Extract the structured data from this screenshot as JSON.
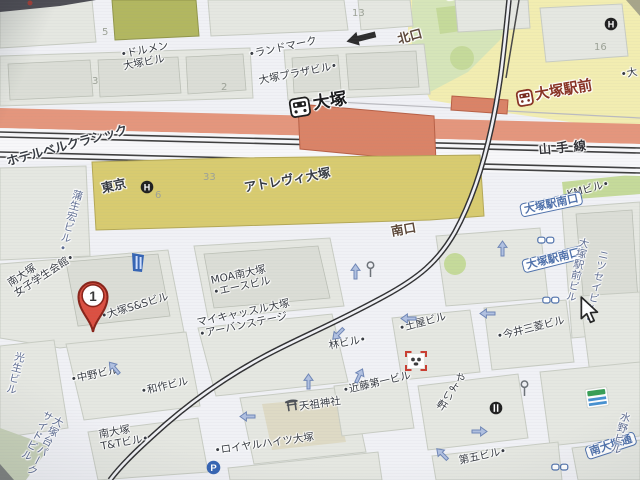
{
  "colors": {
    "road": "#eef0f4",
    "block": "#e3e6df",
    "blockStroke": "#c6cac1",
    "building": "#d9dcd4",
    "buildingStroke": "#b9bdb3",
    "yellow": "#f1ecab",
    "green": "#d4e4b4",
    "green2": "#c2d994",
    "olive": "#b0b657",
    "sage": "#c5cfb5",
    "mustard": "#d8ca67",
    "mustardStroke": "#b3a64e",
    "salmon": "#e79377",
    "salmonDark": "#de7f61",
    "rail": "#3c3c3c",
    "labelBlack": "#33383f",
    "labelBlue": "#5a6a92",
    "stationRed": "#8c2f1f",
    "busBlue": "#4a6fae",
    "exitBrown": "#5a4434",
    "num": "#9aa094",
    "arrowBlue": "#8aa2d0"
  },
  "station": {
    "jr_name": "大塚",
    "tram_stop": "大塚駅前",
    "line": "山手線",
    "north_exit": "北口",
    "south_exit": "南口"
  },
  "pin": {
    "number": "1",
    "points_to": "大塚S&Sビル"
  },
  "labels": [
    {
      "name": "label-mezon-partial",
      "text": "メゾン",
      "x": 376,
      "y": -10,
      "rot": -35,
      "cls": "bldg"
    },
    {
      "name": "label-biru-partial",
      "text": "ビル",
      "x": 444,
      "y": -8,
      "rot": -5,
      "cls": "bldg"
    },
    {
      "name": "block-num-13",
      "text": "13",
      "x": 352,
      "y": 8,
      "cls": "num"
    },
    {
      "name": "block-num-5",
      "text": "5",
      "x": 102,
      "y": 27,
      "cls": "num"
    },
    {
      "name": "block-num-3",
      "text": "3",
      "x": 92,
      "y": 76,
      "cls": "num"
    },
    {
      "name": "block-num-2",
      "text": "2",
      "x": 221,
      "y": 82,
      "cls": "num"
    },
    {
      "name": "block-num-16",
      "text": "16",
      "x": 594,
      "y": 42,
      "cls": "num"
    },
    {
      "name": "block-num-33",
      "text": "33",
      "x": 203,
      "y": 172,
      "cls": "num"
    },
    {
      "name": "block-num-6",
      "text": "6",
      "x": 155,
      "y": 190,
      "cls": "num"
    },
    {
      "name": "label-dolmen-otsuka-building",
      "text": "•ドルメン\n大塚ビル",
      "x": 120,
      "y": 50,
      "rot": -11,
      "cls": "bldg"
    },
    {
      "name": "label-landmark",
      "text": "•ランドマーク",
      "x": 248,
      "y": 50,
      "rot": -12,
      "cls": "bldg"
    },
    {
      "name": "label-otsuka-plaza-building",
      "text": "大塚プラザビル•",
      "x": 258,
      "y": 76,
      "rot": -11,
      "cls": "bldg"
    },
    {
      "name": "label-north-exit",
      "text": "北口",
      "x": 396,
      "y": 33,
      "rot": -15,
      "cls": "exit"
    },
    {
      "name": "label-partial-dai",
      "text": "•大",
      "x": 620,
      "y": 70,
      "rot": -10,
      "cls": "bldg"
    },
    {
      "name": "station-label-otsuka",
      "text": "大塚",
      "x": 288,
      "y": 99,
      "rot": -9,
      "cls": "station",
      "icon": "train"
    },
    {
      "name": "tram-stop-label-otsuka-ekimae",
      "text": "大塚駅前",
      "x": 515,
      "y": 91,
      "rot": -10,
      "cls": "tram-station",
      "icon": "tram"
    },
    {
      "name": "label-yamanote-line",
      "text": "山手線",
      "x": 538,
      "y": 143,
      "rot": -5,
      "cls": "line"
    },
    {
      "name": "label-hotel-bellclassic",
      "text": "ホテルベルクラシック",
      "x": 5,
      "y": 155,
      "rot": -15,
      "cls": "bldg-lg"
    },
    {
      "name": "label-hotel-bellclassic-tokyo",
      "text": "東京",
      "x": 100,
      "y": 182,
      "rot": -13,
      "cls": "bldg-lg"
    },
    {
      "name": "label-atrevie-otsuka",
      "text": "アトレヴィ大塚",
      "x": 243,
      "y": 181,
      "rot": -10,
      "cls": "bldg-lg"
    },
    {
      "name": "label-gamo-hiro-building",
      "text": "蒲生宏ビル•",
      "x": 72,
      "y": 188,
      "rot": 15,
      "cls": "blue",
      "vertical": true
    },
    {
      "name": "label-south-exit",
      "text": "南口",
      "x": 390,
      "y": 225,
      "rot": -10,
      "cls": "exit"
    },
    {
      "name": "label-km-building",
      "text": "KMビル•",
      "x": 566,
      "y": 190,
      "rot": -15,
      "cls": "bldg"
    },
    {
      "name": "bus-stop-otsuka-eki-minamiguchi-1",
      "text": "大塚駅南口",
      "x": 519,
      "y": 204,
      "rot": -12,
      "cls": "bus"
    },
    {
      "name": "bus-stop-otsuka-eki-minamiguchi-2",
      "text": "大塚駅南口",
      "x": 521,
      "y": 260,
      "rot": -14,
      "cls": "bus"
    },
    {
      "name": "label-otsuka-ekimae-building",
      "text": "大塚駅前ビル",
      "x": 578,
      "y": 236,
      "rot": 13,
      "cls": "blue",
      "vertical": true
    },
    {
      "name": "label-nissei-building",
      "text": "ニツセイビル•",
      "x": 598,
      "y": 248,
      "rot": 13,
      "cls": "blue",
      "vertical": true
    },
    {
      "name": "label-minami-otsuka-joshi-gakusei-kaikan",
      "text": "南大塚\n女子学生会館•",
      "x": 6,
      "y": 280,
      "rot": -33,
      "cls": "bldg"
    },
    {
      "name": "label-otsuka-ss-building",
      "text": "•大塚S&Sビル",
      "x": 100,
      "y": 312,
      "rot": -17,
      "cls": "bldg"
    },
    {
      "name": "label-moa-minami-otsuka-ace-building",
      "text": "MOA南大塚\n•エースビル",
      "x": 210,
      "y": 276,
      "rot": -12,
      "cls": "bldg"
    },
    {
      "name": "label-mycastle-otsuka-urban-stage",
      "text": "マイキャッスル大塚\n•アーバンステージ",
      "x": 196,
      "y": 318,
      "rot": -12,
      "cls": "bldg"
    },
    {
      "name": "label-hayashi-building",
      "text": "林ビル•",
      "x": 328,
      "y": 341,
      "rot": -10,
      "cls": "bldg"
    },
    {
      "name": "label-tsuchiya-building",
      "text": "•土屋ビル",
      "x": 398,
      "y": 324,
      "rot": -15,
      "cls": "bldg"
    },
    {
      "name": "label-imai-mitsubishi-building",
      "text": "•今井三菱ビル",
      "x": 496,
      "y": 332,
      "rot": -14,
      "cls": "bldg"
    },
    {
      "name": "label-yayoiken",
      "text": "やよい軒",
      "x": 457,
      "y": 369,
      "rot": 33,
      "cls": "bldg",
      "vertical": true
    },
    {
      "name": "label-kondo-daiichi-building",
      "text": "•近藤第一ビル",
      "x": 342,
      "y": 386,
      "rot": -13,
      "cls": "bldg"
    },
    {
      "name": "label-tenso-shrine",
      "text": "天祖神社",
      "x": 284,
      "y": 400,
      "rot": -8,
      "cls": "bldg",
      "icon": "torii"
    },
    {
      "name": "label-nakano-building",
      "text": "•中野ビル",
      "x": 70,
      "y": 375,
      "rot": -12,
      "cls": "bldg"
    },
    {
      "name": "label-wasaku-building",
      "text": "•和作ビル",
      "x": 140,
      "y": 387,
      "rot": -13,
      "cls": "bldg"
    },
    {
      "name": "label-minami-otsuka-tt-building",
      "text": "南大塚\nT&Tビル•",
      "x": 98,
      "y": 430,
      "rot": -10,
      "cls": "bldg"
    },
    {
      "name": "label-kosei-building",
      "text": "光生ビル",
      "x": 14,
      "y": 350,
      "rot": 14,
      "cls": "blue",
      "vertical": true
    },
    {
      "name": "label-otsukadai-parkside-building",
      "text": "大塚台パーク\nサイドビル",
      "x": 44,
      "y": 408,
      "rot": 28,
      "cls": "blue",
      "vertical": true
    },
    {
      "name": "label-royal-heights-otsuka",
      "text": "•ロイヤルハイツ大塚",
      "x": 214,
      "y": 446,
      "rot": -8,
      "cls": "bldg"
    },
    {
      "name": "label-daigo-building-partial",
      "text": "第五ビル•",
      "x": 458,
      "y": 456,
      "rot": -12,
      "cls": "bldg"
    },
    {
      "name": "bus-stop-minami-otsuka-dori",
      "text": "南大塚通",
      "x": 584,
      "y": 447,
      "rot": -18,
      "cls": "bus"
    },
    {
      "name": "label-mizuno-building",
      "text": "水野ビル",
      "x": 620,
      "y": 410,
      "rot": 16,
      "cls": "blue",
      "vertical": true
    }
  ],
  "icons": [
    {
      "name": "hotel-icon-bellclassic",
      "type": "hotel",
      "x": 140,
      "y": 179,
      "glyph": "H"
    },
    {
      "name": "hotel-icon-top-right",
      "type": "hotel",
      "x": 604,
      "y": 16,
      "glyph": "H"
    },
    {
      "name": "map-pin-1",
      "type": "pin",
      "x": 74,
      "y": 276,
      "glyph": "1"
    },
    {
      "name": "blue-poi-icon",
      "type": "blue-poi",
      "x": 128,
      "y": 251
    },
    {
      "name": "restaurant-icon",
      "type": "restaurant",
      "x": 489,
      "y": 400
    },
    {
      "name": "parking-icon",
      "type": "parking",
      "x": 206,
      "y": 460,
      "glyph": "P"
    },
    {
      "name": "signal-icon-1",
      "type": "signal",
      "x": 366,
      "y": 261
    },
    {
      "name": "signal-icon-2",
      "type": "signal",
      "x": 520,
      "y": 380
    },
    {
      "name": "red-frame-poi-icon",
      "type": "panda",
      "x": 405,
      "y": 351
    },
    {
      "name": "striped-flag-bath-icon",
      "type": "bath",
      "x": 585,
      "y": 387
    },
    {
      "name": "bus-icon-pair-1",
      "type": "bus-pair",
      "x": 537,
      "y": 230
    },
    {
      "name": "bus-icon-pair-2",
      "type": "bus-pair",
      "x": 542,
      "y": 290
    },
    {
      "name": "bus-icon-pair-3",
      "type": "bus-pair",
      "x": 551,
      "y": 457
    },
    {
      "name": "one-way-arrow-black",
      "type": "arrow-black",
      "x": 344,
      "y": 30
    },
    {
      "name": "mouse-cursor",
      "type": "cursor",
      "x": 578,
      "y": 295
    }
  ],
  "arrows": [
    {
      "x": 497,
      "y": 240,
      "r": 0
    },
    {
      "x": 405,
      "y": 308,
      "r": -90
    },
    {
      "x": 484,
      "y": 303,
      "r": -90
    },
    {
      "x": 334,
      "y": 322,
      "r": -135
    },
    {
      "x": 350,
      "y": 263,
      "r": 0
    },
    {
      "x": 244,
      "y": 406,
      "r": -90
    },
    {
      "x": 303,
      "y": 373,
      "r": 0
    },
    {
      "x": 353,
      "y": 367,
      "r": 25
    },
    {
      "x": 110,
      "y": 359,
      "r": -40
    },
    {
      "x": 438,
      "y": 445,
      "r": -45
    },
    {
      "x": 472,
      "y": 421,
      "r": 90
    }
  ]
}
